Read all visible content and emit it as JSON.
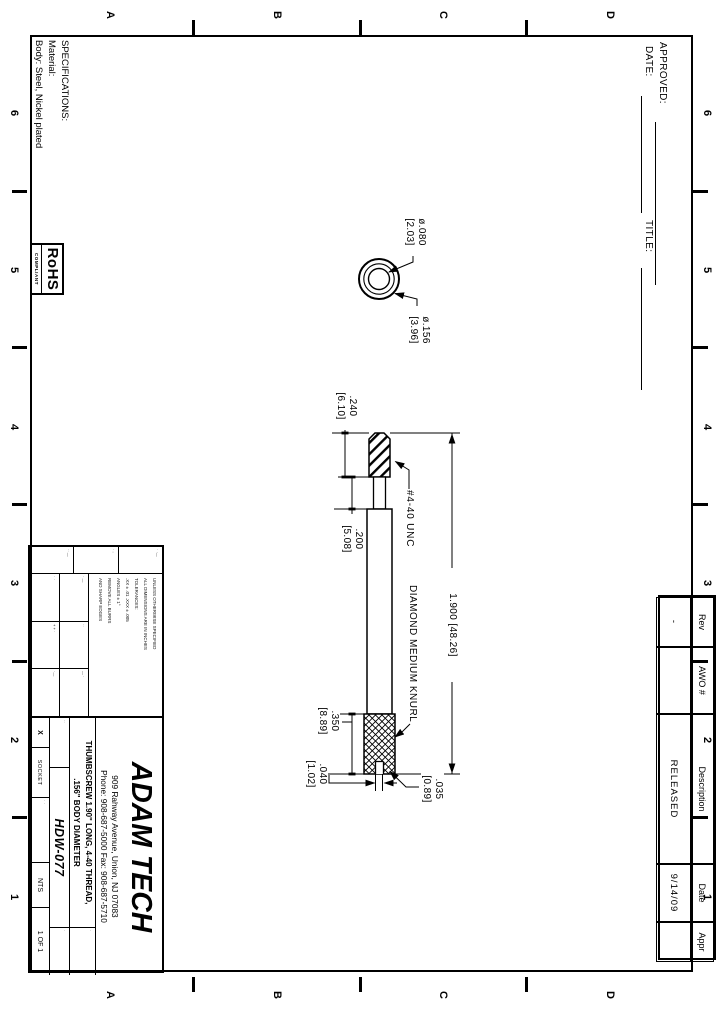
{
  "zones": {
    "cols": [
      "6",
      "5",
      "4",
      "3",
      "2",
      "1"
    ],
    "rows": [
      "D",
      "C",
      "B",
      "A"
    ]
  },
  "approval": {
    "approved": "APPROVED:",
    "date": "DATE:",
    "title": "TITLE:"
  },
  "rev_table": {
    "headers": [
      "Rev",
      "AWO #",
      "Description",
      "Date",
      "Appr"
    ],
    "row": {
      "rev": "-",
      "awo": "",
      "description": "RELEASED",
      "date": "9/14/09",
      "appr": ""
    }
  },
  "specs": {
    "line1": "SPECIFICATIONS:",
    "line2": "Material:",
    "line3": "Body: Steel, Nickel plated"
  },
  "rohs": {
    "big": "RoHS",
    "small": "COMPLIANT"
  },
  "title_block": {
    "company": "ADAM TECH",
    "address": "909 Rahway Avenue, Union, NJ 07083",
    "phone": "Phone: 908-687-5000 Fax: 908-687-5710",
    "title1": "THUMBSCREW 1.90\" LONG, 4-40 THREAD,",
    "title2": ".156\" BODY DIAMETER",
    "part_number": "HDW-077",
    "category": "SOCKET",
    "scale": "NTS",
    "sheet_of": "1 OF 1",
    "projection": "X",
    "tolerance_notes": [
      "UNLESS OTHERWISE SPECIFIED",
      "ALL DIMENSIONS ARE IN INCHES",
      "TOLERANCES:",
      ".XX ± .01   .XXX ± .005",
      "ANGLES ± 1°",
      "REMOVE ALL BURRS",
      "AND SHARP EDGES"
    ],
    "left_cells": [
      "· ·—",
      "· :",
      "·· —"
    ],
    "sub_cells": [
      "· —",
      "··",
      "— ·",
      "· ·",
      "+ + ·",
      "·—"
    ]
  },
  "drawing": {
    "thread_label": "#4-40 UNC",
    "knurl_label": "DIAMOND MEDIUM KNURL",
    "dim_overall": "1.900 [48.26]",
    "dim_thread": {
      "in": ".240",
      "mm": "[6.10]"
    },
    "dim_neck": {
      "in": ".200",
      "mm": "[5.08]"
    },
    "dim_knurl": {
      "in": ".350",
      "mm": "[8.89]"
    },
    "dim_slot_w": {
      "in": ".040",
      "mm": "[1.02]"
    },
    "dim_slot_d": {
      "in": ".035",
      "mm": "[0.89]"
    },
    "dim_end_small": {
      "in": "ø.080",
      "mm": "[2.03]"
    },
    "dim_end_large": {
      "in": "ø.156",
      "mm": "[3.96]"
    }
  }
}
